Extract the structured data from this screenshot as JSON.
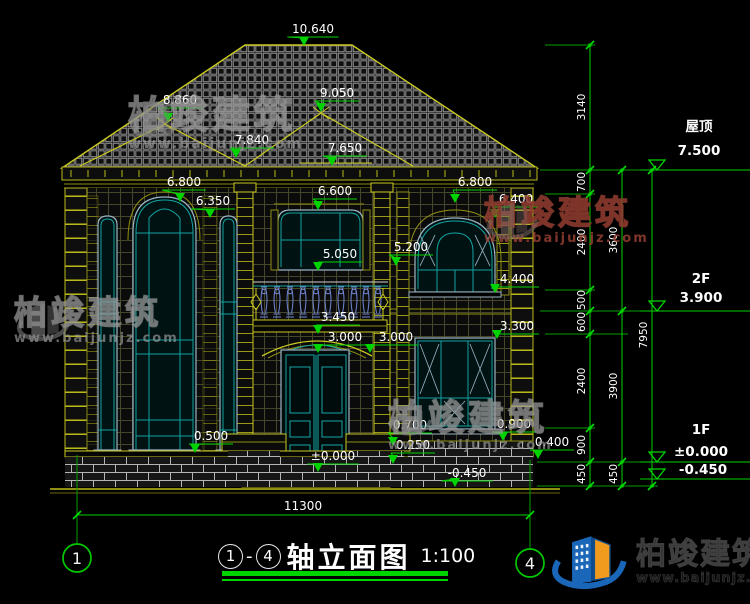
{
  "title": {
    "axis_start": "1",
    "dash": "-",
    "axis_end": "4",
    "text": "轴立面图",
    "scale": "1:100"
  },
  "brand": {
    "name": "柏竣建筑",
    "url": "www.baijunjz.com"
  },
  "drawing": {
    "ground_dim": {
      "t": "11300",
      "x": 303,
      "y": 510
    },
    "axes": [
      {
        "n": "1",
        "x": 77,
        "y": 558
      },
      {
        "n": "4",
        "x": 530,
        "y": 563
      }
    ],
    "floor_levels": [
      {
        "name": "屋顶",
        "value": "7.500",
        "tx": 699,
        "name_y": 131,
        "val_y": 155,
        "line_y": 170
      },
      {
        "name": "2F",
        "value": "3.900",
        "tx": 701,
        "name_y": 283,
        "val_y": 302,
        "line_y": 311
      },
      {
        "name": "1F",
        "value": "±0.000",
        "tx": 701,
        "name_y": 434,
        "val_y": 456,
        "line_y": 462
      },
      {
        "name": "",
        "value": "-0.450",
        "tx": 703,
        "name_y": 0,
        "val_y": 474,
        "line_y": 479
      }
    ],
    "elev_markers": [
      {
        "t": "10.640",
        "x": 313,
        "y": 33,
        "ax": 304,
        "ay": 46
      },
      {
        "t": "9.050",
        "x": 337,
        "y": 97,
        "ax": 321,
        "ay": 112
      },
      {
        "t": "8.860",
        "x": 180,
        "y": 104,
        "ax": 168,
        "ay": 122
      },
      {
        "t": "7.840",
        "x": 252,
        "y": 144,
        "ax": 236,
        "ay": 158
      },
      {
        "t": "7.650",
        "x": 345,
        "y": 152,
        "ax": 332,
        "ay": 166
      },
      {
        "t": "6.800",
        "x": 184,
        "y": 186,
        "ax": 180,
        "ay": 202
      },
      {
        "t": "6.350",
        "x": 213,
        "y": 205,
        "ax": 210,
        "ay": 218
      },
      {
        "t": "6.600",
        "x": 335,
        "y": 195,
        "ax": 318,
        "ay": 210
      },
      {
        "t": "6.800",
        "x": 475,
        "y": 186,
        "ax": 455,
        "ay": 203
      },
      {
        "t": "6.400",
        "x": 516,
        "y": 203,
        "ax": 495,
        "ay": 218
      },
      {
        "t": "5.200",
        "x": 411,
        "y": 251,
        "ax": 396,
        "ay": 266
      },
      {
        "t": "5.050",
        "x": 340,
        "y": 258,
        "ax": 318,
        "ay": 271
      },
      {
        "t": "4.400",
        "x": 517,
        "y": 283,
        "ax": 495,
        "ay": 293
      },
      {
        "t": "3.450",
        "x": 338,
        "y": 321,
        "ax": 318,
        "ay": 334
      },
      {
        "t": "3.000",
        "x": 345,
        "y": 341,
        "ax": 318,
        "ay": 353
      },
      {
        "t": "3.000",
        "x": 396,
        "y": 341,
        "ax": 370,
        "ay": 353
      },
      {
        "t": "3.300",
        "x": 517,
        "y": 330,
        "ax": 497,
        "ay": 339
      },
      {
        "t": "0.500",
        "x": 211,
        "y": 440,
        "ax": 195,
        "ay": 453
      },
      {
        "t": "0.700",
        "x": 410,
        "y": 429,
        "ax": 393,
        "ay": 446
      },
      {
        "t": "0.250",
        "x": 413,
        "y": 449,
        "ax": 393,
        "ay": 464
      },
      {
        "t": "0.900",
        "x": 514,
        "y": 428,
        "ax": 503,
        "ay": 441
      },
      {
        "t": "0.400",
        "x": 552,
        "y": 446,
        "ax": 538,
        "ay": 459
      },
      {
        "t": "±0.000",
        "x": 333,
        "y": 460,
        "ax": 318,
        "ay": 472
      },
      {
        "t": "-0.450",
        "x": 467,
        "y": 477,
        "ax": 455,
        "ay": 487
      }
    ],
    "dim_chains": [
      {
        "x": 590,
        "ticks": [
          45,
          170,
          194,
          290,
          311,
          334,
          428,
          462,
          486
        ],
        "labels": [
          {
            "t": "3140",
            "y": 107
          },
          {
            "t": "700",
            "y": 182
          },
          {
            "t": "2400",
            "y": 242
          },
          {
            "t": "500",
            "y": 300
          },
          {
            "t": "600",
            "y": 322
          },
          {
            "t": "2400",
            "y": 381
          },
          {
            "t": "900",
            "y": 445
          },
          {
            "t": "450",
            "y": 474
          }
        ]
      },
      {
        "x": 622,
        "ticks": [
          170,
          311,
          462,
          486
        ],
        "labels": [
          {
            "t": "3600",
            "y": 240
          },
          {
            "t": "3900",
            "y": 386
          },
          {
            "t": "450",
            "y": 474
          }
        ]
      },
      {
        "x": 652,
        "ticks": [
          170,
          486
        ],
        "labels": [
          {
            "t": "7950",
            "y": 335
          }
        ]
      }
    ]
  }
}
